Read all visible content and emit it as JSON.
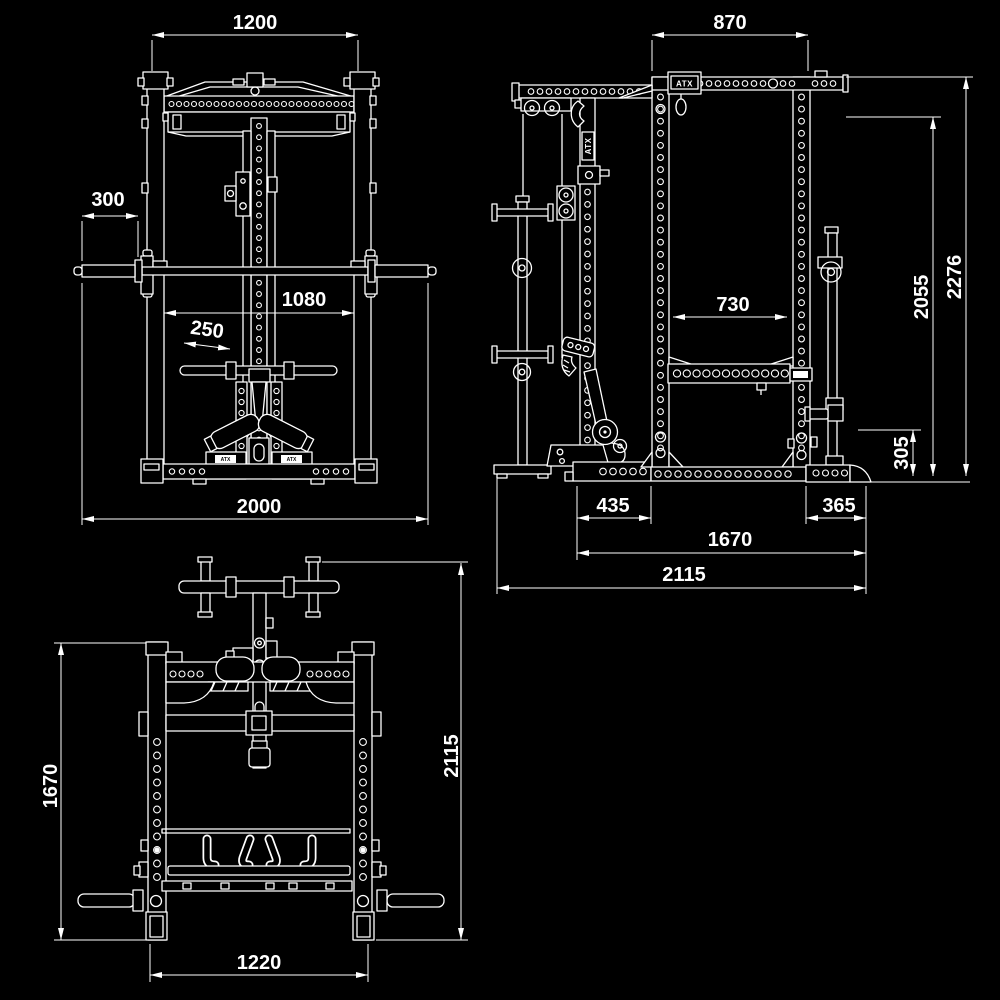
{
  "meta": {
    "background_color": "#000000",
    "line_color": "#ffffff"
  },
  "brand": {
    "name": "ATX"
  },
  "views": {
    "front": {
      "dims": {
        "top_width": "1200",
        "sleeve_length": "300",
        "inner_width": "1080",
        "handle_length": "250",
        "overall_width": "2000"
      }
    },
    "side": {
      "dims": {
        "top_depth": "870",
        "overall_height": "2276",
        "rack_height": "2055",
        "inner_depth": "730",
        "base_height": "305",
        "front_foot": "435",
        "rear_foot": "365",
        "base_depth": "1670",
        "overall_depth": "2115"
      }
    },
    "top": {
      "dims": {
        "frame_length": "1670",
        "overall_length": "2115",
        "base_width": "1220"
      }
    }
  }
}
